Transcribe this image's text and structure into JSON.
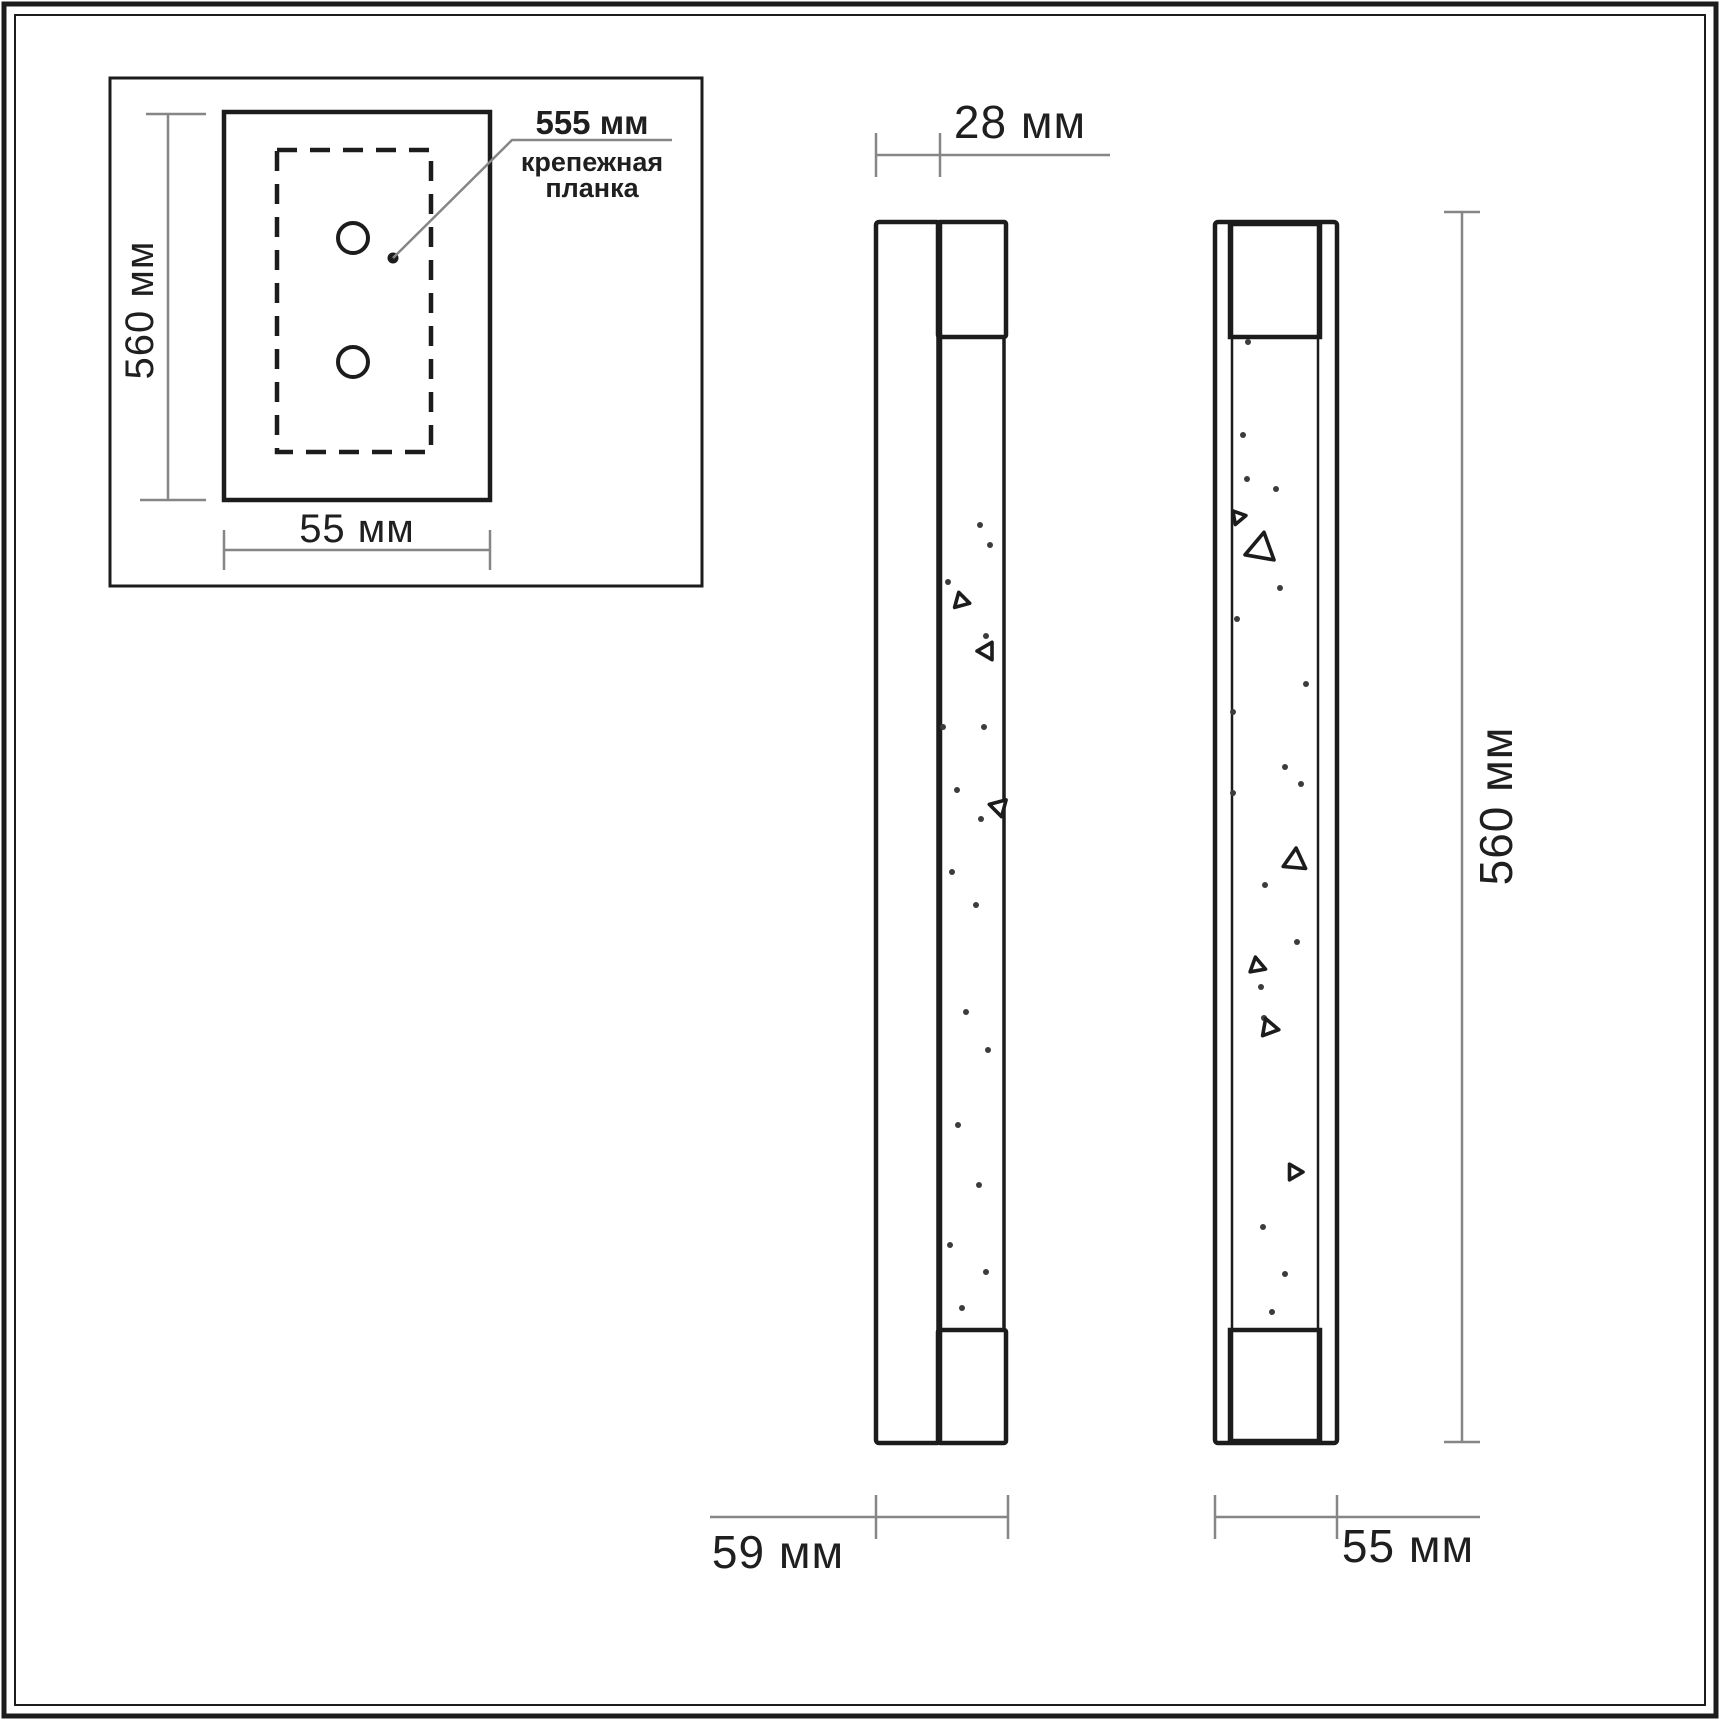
{
  "colors": {
    "line": "#1c1c1c",
    "dim": "#868686",
    "text": "#1f1f1f",
    "background": "#ffffff"
  },
  "inset": {
    "height_label": "560 мм",
    "width_label": "55 мм",
    "callout": {
      "value": "555 мм",
      "line1": "крепежная",
      "line2": "планка"
    }
  },
  "side_view": {
    "depth_back_label": "28 мм",
    "depth_total_label": "59 мм"
  },
  "front_view": {
    "height_label": "560 мм",
    "width_label": "55 мм"
  },
  "texture": {
    "dot_radius": 3,
    "side_dots": [
      [
        980,
        525
      ],
      [
        990,
        545
      ],
      [
        948,
        582
      ],
      [
        986,
        636
      ],
      [
        943,
        727
      ],
      [
        984,
        727
      ],
      [
        957,
        790
      ],
      [
        981,
        819
      ],
      [
        952,
        872
      ],
      [
        976,
        905
      ],
      [
        966,
        1012
      ],
      [
        988,
        1050
      ],
      [
        958,
        1125
      ],
      [
        979,
        1185
      ],
      [
        950,
        1245
      ],
      [
        986,
        1272
      ],
      [
        962,
        1308
      ]
    ],
    "side_triangles": [
      [
        961,
        601,
        9,
        -15
      ],
      [
        987,
        651,
        10,
        150
      ],
      [
        999,
        807,
        10,
        165
      ]
    ],
    "front_dots": [
      [
        1248,
        342
      ],
      [
        1243,
        435
      ],
      [
        1247,
        479
      ],
      [
        1276,
        489
      ],
      [
        1280,
        588
      ],
      [
        1237,
        619
      ],
      [
        1306,
        684
      ],
      [
        1233,
        712
      ],
      [
        1285,
        767
      ],
      [
        1301,
        784
      ],
      [
        1233,
        793
      ],
      [
        1265,
        885
      ],
      [
        1297,
        942
      ],
      [
        1261,
        987
      ],
      [
        1264,
        1018
      ],
      [
        1263,
        1227
      ],
      [
        1285,
        1274
      ],
      [
        1272,
        1312
      ]
    ],
    "front_triangles": [
      [
        1238,
        517,
        8,
        -40
      ],
      [
        1261,
        549,
        17,
        10
      ],
      [
        1295,
        861,
        13,
        5
      ],
      [
        1257,
        966,
        9,
        -10
      ],
      [
        1269,
        1028,
        10,
        -140
      ],
      [
        1294,
        1172,
        9,
        -30
      ]
    ]
  }
}
